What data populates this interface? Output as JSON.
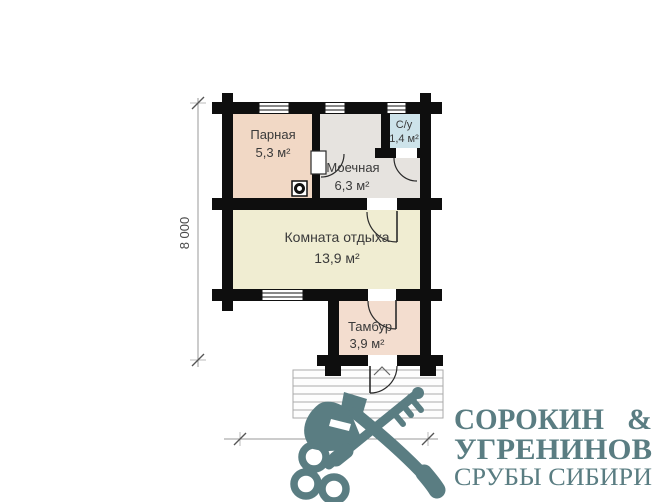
{
  "plan": {
    "rooms": [
      {
        "name": "Парная",
        "area": "5,3 м²"
      },
      {
        "name": "Моечная",
        "area": "6,3 м²"
      },
      {
        "name": "С/у",
        "area": "1,4 м²"
      },
      {
        "name": "Комната отдыха",
        "area": "13,9 м²"
      },
      {
        "name": "Тамбур",
        "area": "3,9 м²"
      }
    ],
    "dimensions": {
      "vertical": "8 000",
      "horizontal": "6 000"
    }
  },
  "logo": {
    "line1": "СОРОКИН",
    "amp": "&",
    "line2": "УГРЕНИНОВ",
    "tagline": "СРУБЫ СИБИРИ"
  },
  "colors": {
    "wall": "#0e0e0e",
    "parnaya": "#f1d8c5",
    "moechnaya": "#e6e3df",
    "su": "#cde3ea",
    "komnata": "#f0edd2",
    "tambur": "#f3ddcf",
    "stairs_line": "#aaaaaa",
    "door_line": "#2a2a2a",
    "label": "#3a3a3a",
    "dimension": "#4a4a4a",
    "logo": "#5a7d82"
  }
}
